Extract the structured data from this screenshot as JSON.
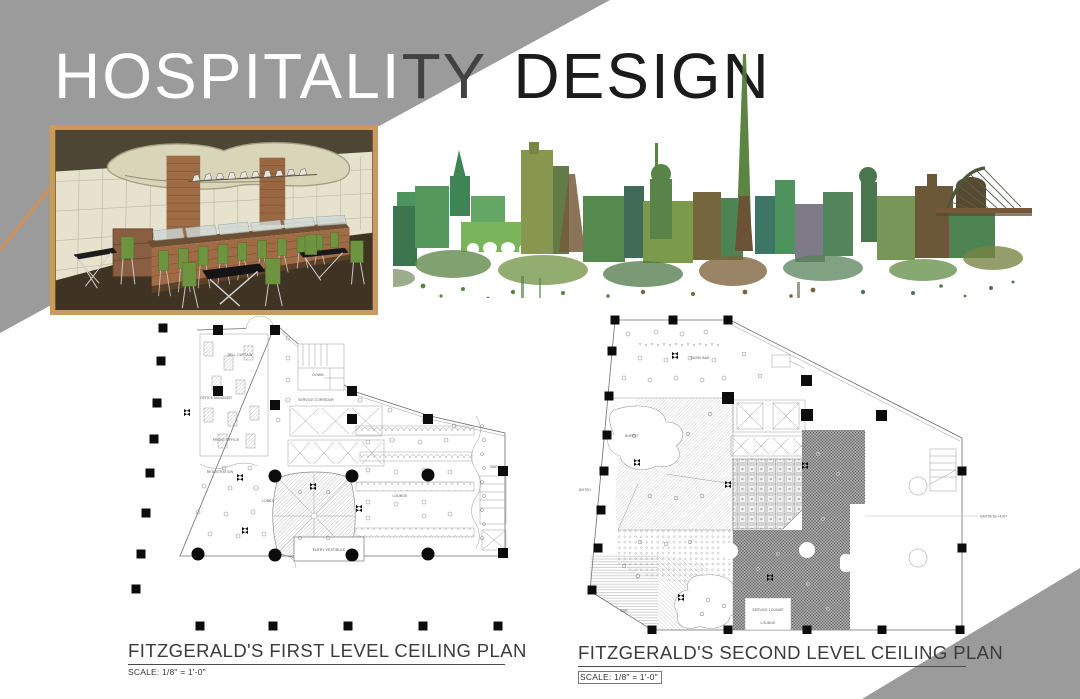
{
  "title": {
    "seg1": "HOSPITALI",
    "seg2": "TY",
    "seg3": "DESIGN"
  },
  "hero": {
    "rendering_name": "buffet-bar-interior-rendering",
    "skyline_name": "dublin-skyline-watercolor"
  },
  "plans": [
    {
      "caption": "FITZGERALD'S FIRST LEVEL CEILING PLAN",
      "scale": "SCALE: 1/8\" =  1'-0\"",
      "rooms": {
        "bell_captain": "BELL CAPTAIN",
        "office_manager": "OFFICE MANAGER",
        "front_office": "FRONT OFFICE",
        "registration": "REGISTRATION",
        "lobby": "LOBBY",
        "service_corridor": "SERVICE CORRIDOR",
        "lounge": "LOUNGE",
        "entry_vestibule": "ENTRY VESTIBULE",
        "down": "DOWN",
        "bar": "BAR"
      }
    },
    {
      "caption": "FITZGERALD'S SECOND LEVEL CEILING PLAN",
      "scale": "SCALE: 1/8\" =  1'-0\"",
      "rooms": {
        "sushi_bar": "SUSHI BAR",
        "buffet": "BUFFET",
        "bistro": "BISTRO",
        "service_lounge": "SERVICE LOUNGE",
        "lounge": "LOUNGE",
        "bar": "BAR",
        "maitre": "MAITRE DE HOST"
      }
    }
  ],
  "colors": {
    "corner_gray": "#9b9b9b",
    "frame_border": "#c9995f",
    "title_light": "#ffffff",
    "title_mid": "#424242",
    "title_dark": "#1b1b1b"
  }
}
